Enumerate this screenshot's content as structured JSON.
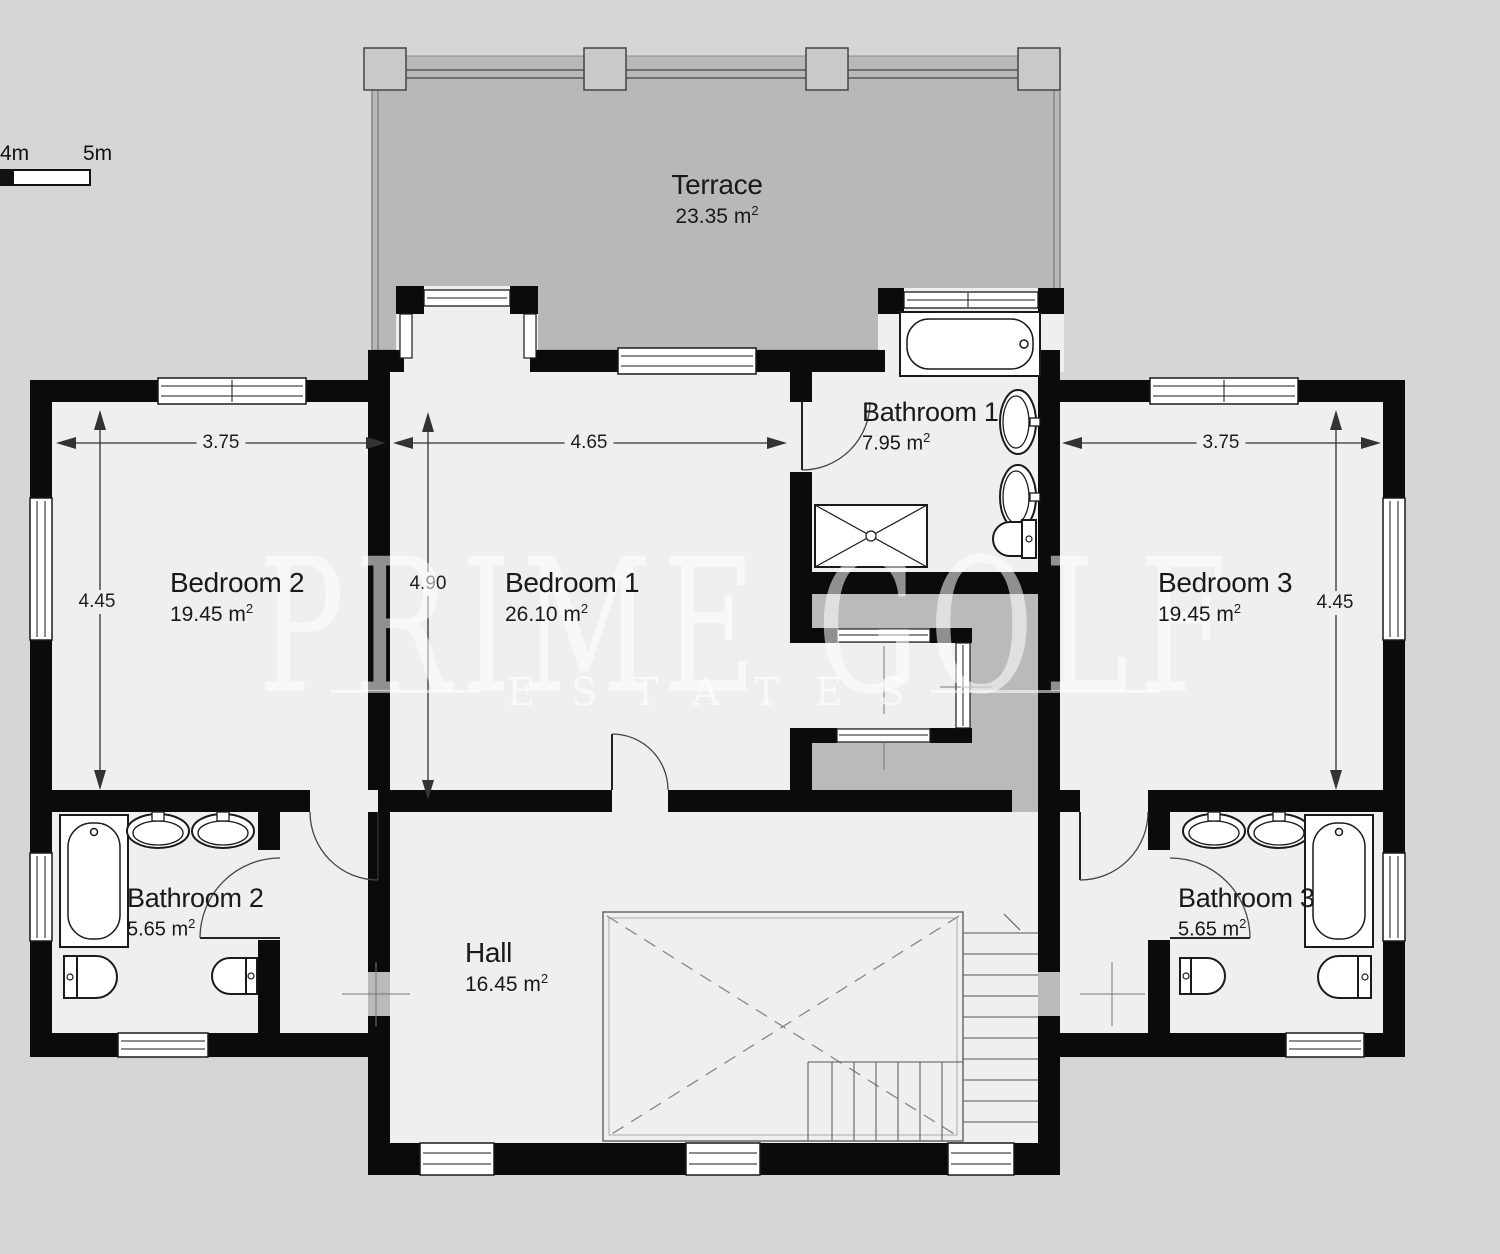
{
  "scale_bar": {
    "tick_4m": "4m",
    "tick_5m": "5m"
  },
  "watermark": {
    "line1": "PRIME GOLF",
    "line2": "ESTATES"
  },
  "units": {
    "meter_prefix": "m",
    "superscript": "2"
  },
  "rooms": {
    "terrace": {
      "name": "Terrace",
      "area_value": "23.35"
    },
    "bedroom1": {
      "name": "Bedroom 1",
      "area_value": "26.10"
    },
    "bedroom2": {
      "name": "Bedroom 2",
      "area_value": "19.45"
    },
    "bedroom3": {
      "name": "Bedroom 3",
      "area_value": "19.45"
    },
    "bathroom1": {
      "name": "Bathroom 1",
      "area_value": "7.95"
    },
    "bathroom2": {
      "name": "Bathroom 2",
      "area_value": "5.65"
    },
    "bathroom3": {
      "name": "Bathroom 3",
      "area_value": "5.65"
    },
    "hall": {
      "name": "Hall",
      "area_value": "16.45"
    }
  },
  "dimensions": {
    "bedroom2_width": "3.75",
    "bedroom1_width": "4.65",
    "bedroom3_width": "3.75",
    "bedroom2_height": "4.45",
    "bedroom1_height": "4.90",
    "bedroom3_height": "4.45"
  },
  "colors": {
    "background": "#d6d6d6",
    "terrace_floor": "#b8b8b8",
    "room_floor": "#f0efee",
    "wall": "#0b0b0b",
    "landing_floor": "#bababa"
  }
}
